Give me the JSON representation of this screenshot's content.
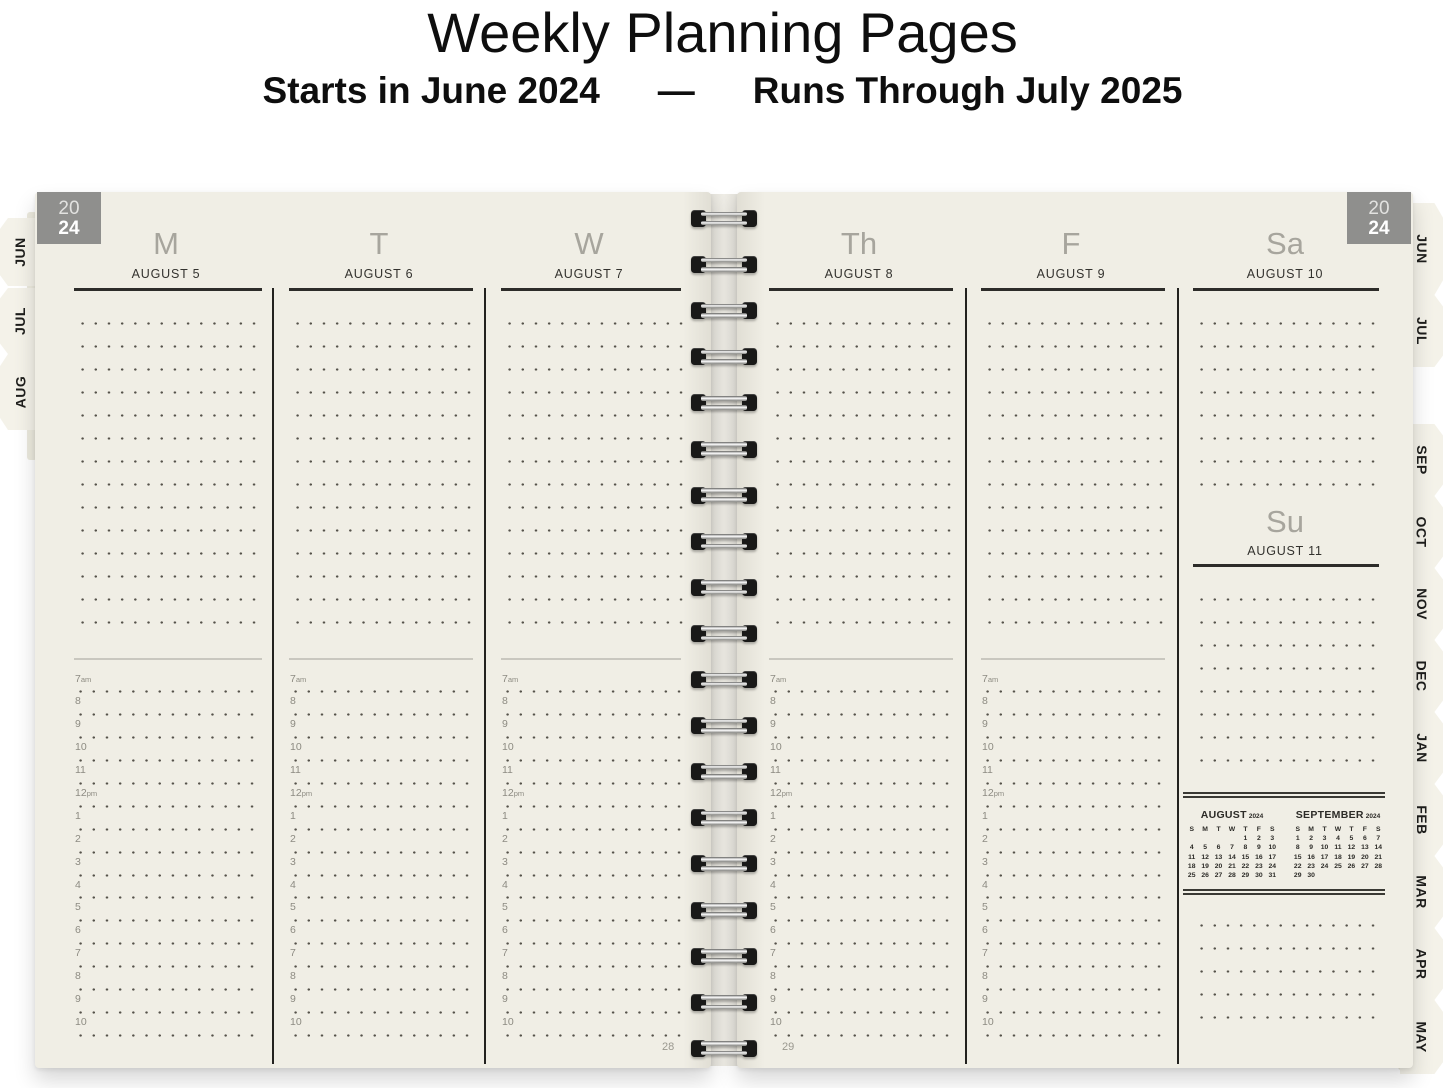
{
  "header": {
    "title": "Weekly Planning Pages",
    "subtitle_start": "Starts in June 2024",
    "subtitle_dash": "—",
    "subtitle_end": "Runs Through July 2025"
  },
  "year_badge": {
    "line1": "20",
    "line2": "24"
  },
  "tabs": {
    "left": [
      "JUN",
      "JUL",
      "AUG"
    ],
    "right": [
      "JUN",
      "JUL",
      "SEP",
      "OCT",
      "NOV",
      "DEC",
      "JAN",
      "FEB",
      "MAR",
      "APR",
      "MAY"
    ]
  },
  "week": {
    "days": [
      {
        "abbr": "M",
        "date": "AUGUST 5"
      },
      {
        "abbr": "T",
        "date": "AUGUST 6"
      },
      {
        "abbr": "W",
        "date": "AUGUST 7"
      },
      {
        "abbr": "Th",
        "date": "AUGUST 8"
      },
      {
        "abbr": "F",
        "date": "AUGUST 9"
      }
    ],
    "saturday": {
      "abbr": "Sa",
      "date": "AUGUST 10"
    },
    "sunday": {
      "abbr": "Su",
      "date": "AUGUST 11"
    }
  },
  "time_slots": [
    {
      "t": "7",
      "s": "am"
    },
    {
      "t": "8",
      "s": ""
    },
    {
      "t": "9",
      "s": ""
    },
    {
      "t": "10",
      "s": ""
    },
    {
      "t": "11",
      "s": ""
    },
    {
      "t": "12",
      "s": "pm"
    },
    {
      "t": "1",
      "s": ""
    },
    {
      "t": "2",
      "s": ""
    },
    {
      "t": "3",
      "s": ""
    },
    {
      "t": "4",
      "s": ""
    },
    {
      "t": "5",
      "s": ""
    },
    {
      "t": "6",
      "s": ""
    },
    {
      "t": "7",
      "s": ""
    },
    {
      "t": "8",
      "s": ""
    },
    {
      "t": "9",
      "s": ""
    },
    {
      "t": "10",
      "s": ""
    }
  ],
  "mini_calendars": [
    {
      "month": "AUGUST",
      "year": "2024",
      "dow": [
        "S",
        "M",
        "T",
        "W",
        "T",
        "F",
        "S"
      ],
      "weeks": [
        [
          "",
          "",
          "",
          "",
          "1",
          "2",
          "3"
        ],
        [
          "4",
          "5",
          "6",
          "7",
          "8",
          "9",
          "10"
        ],
        [
          "11",
          "12",
          "13",
          "14",
          "15",
          "16",
          "17"
        ],
        [
          "18",
          "19",
          "20",
          "21",
          "22",
          "23",
          "24"
        ],
        [
          "25",
          "26",
          "27",
          "28",
          "29",
          "30",
          "31"
        ]
      ]
    },
    {
      "month": "SEPTEMBER",
      "year": "2024",
      "dow": [
        "S",
        "M",
        "T",
        "W",
        "T",
        "F",
        "S"
      ],
      "weeks": [
        [
          "1",
          "2",
          "3",
          "4",
          "5",
          "6",
          "7"
        ],
        [
          "8",
          "9",
          "10",
          "11",
          "12",
          "13",
          "14"
        ],
        [
          "15",
          "16",
          "17",
          "18",
          "19",
          "20",
          "21"
        ],
        [
          "22",
          "23",
          "24",
          "25",
          "26",
          "27",
          "28"
        ],
        [
          "29",
          "30",
          "",
          "",
          "",
          "",
          ""
        ]
      ]
    }
  ],
  "page_numbers": {
    "left": "28",
    "right": "29"
  },
  "colors": {
    "page_cream": "#F0EEE5",
    "badge_gray": "#8F8F8D",
    "ink": "#33322E",
    "muted_header": "#A7A59D",
    "dot": "#55524A",
    "time_label": "#8D8B82",
    "tab_text": "#1E1E1C"
  }
}
